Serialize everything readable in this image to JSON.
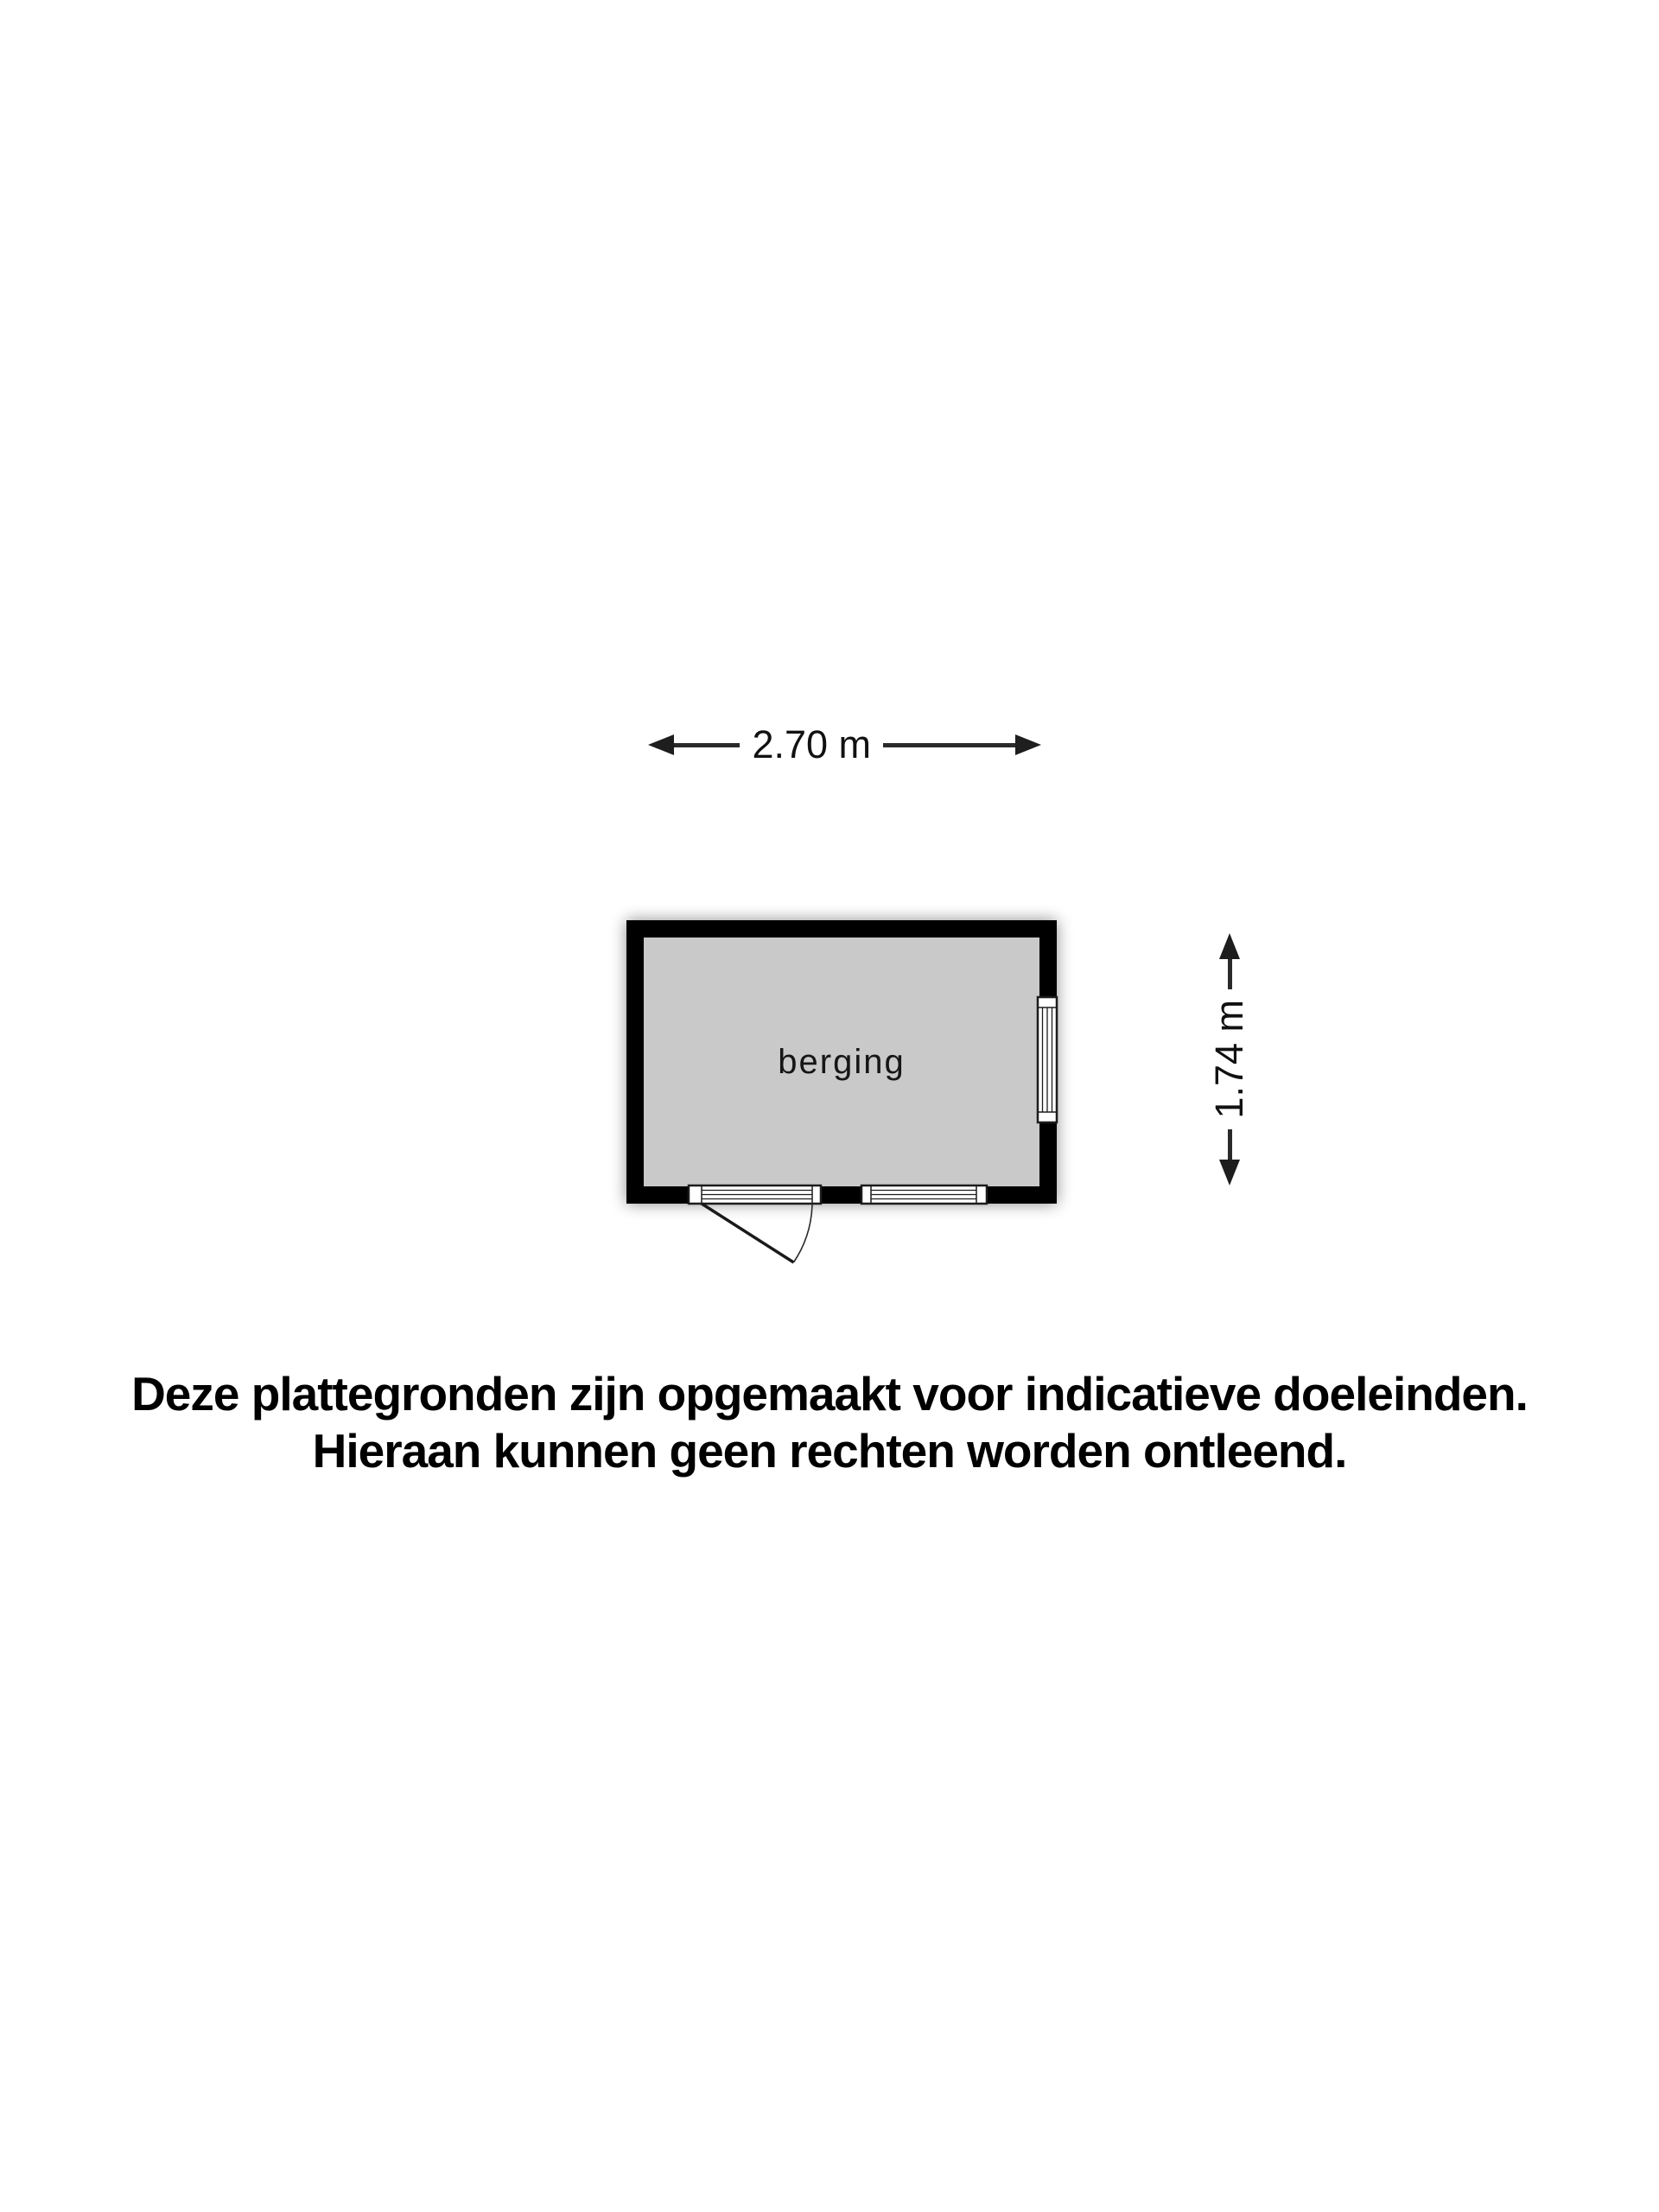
{
  "page": {
    "background_color": "#ffffff"
  },
  "plan": {
    "room_label": "berging",
    "width_label": "2.70 m",
    "height_label": "1.74 m",
    "colors": {
      "wall": "#000000",
      "floor": "#c9c9c9",
      "dimension_line": "#2a2a2a",
      "window_frame": "#1c1c1c",
      "opening_fill": "#ffffff"
    }
  },
  "disclaimer": {
    "line1": "Deze plattegronden zijn opgemaakt voor indicatieve doeleinden.",
    "line2": "Hieraan kunnen geen rechten worden ontleend."
  }
}
